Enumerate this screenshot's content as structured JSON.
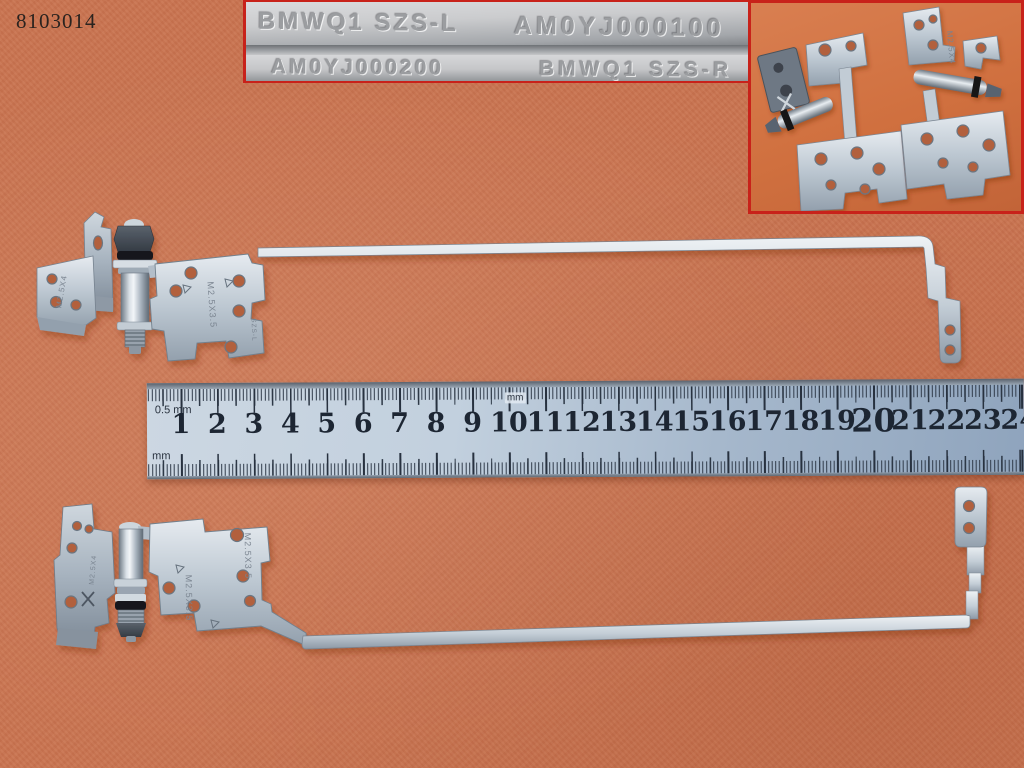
{
  "photo_id": "8103014",
  "strips": {
    "rows": [
      {
        "left": "BMWQ1 SZS-L",
        "right": "AM0YJ000100"
      },
      {
        "left": "AM0YJ000200",
        "right": "BMWQ1 SZS-R"
      }
    ]
  },
  "inset": {
    "marking": "M2.5X4"
  },
  "ruler": {
    "numbers": [
      1,
      2,
      3,
      4,
      5,
      6,
      7,
      8,
      9,
      10,
      11,
      12,
      13,
      14,
      15,
      16,
      17,
      18,
      19,
      20,
      21,
      22,
      23,
      24
    ],
    "emphasized_number": 20,
    "label_top_left": "0.5 mm",
    "label_bottom_left": "mm",
    "label_mid": "mm"
  },
  "hinges": {
    "top": {
      "side": "left",
      "bracket_marking": "M2.5X4",
      "plate_marking": "M2.5X3.5",
      "plate_marking_secondary": "SZS-L"
    },
    "bottom": {
      "side": "right",
      "bracket_marking": "M2.5X4",
      "plate_marking": "M2.5X3.5",
      "plate_marking_secondary": "M2.5X3.5"
    }
  },
  "colors": {
    "background": "#c97450",
    "inset_border": "#c8221a",
    "metal_light": "#e6ebf0",
    "metal_mid": "#b4c0cb",
    "metal_dark": "#76828f",
    "ruler_steel_light": "#ccd7e2",
    "ruler_steel_dark": "#8fa4bd",
    "ruler_ink": "#1d2633",
    "stamp_gray": "#9b9da0",
    "o_ring_black": "#17181a"
  }
}
